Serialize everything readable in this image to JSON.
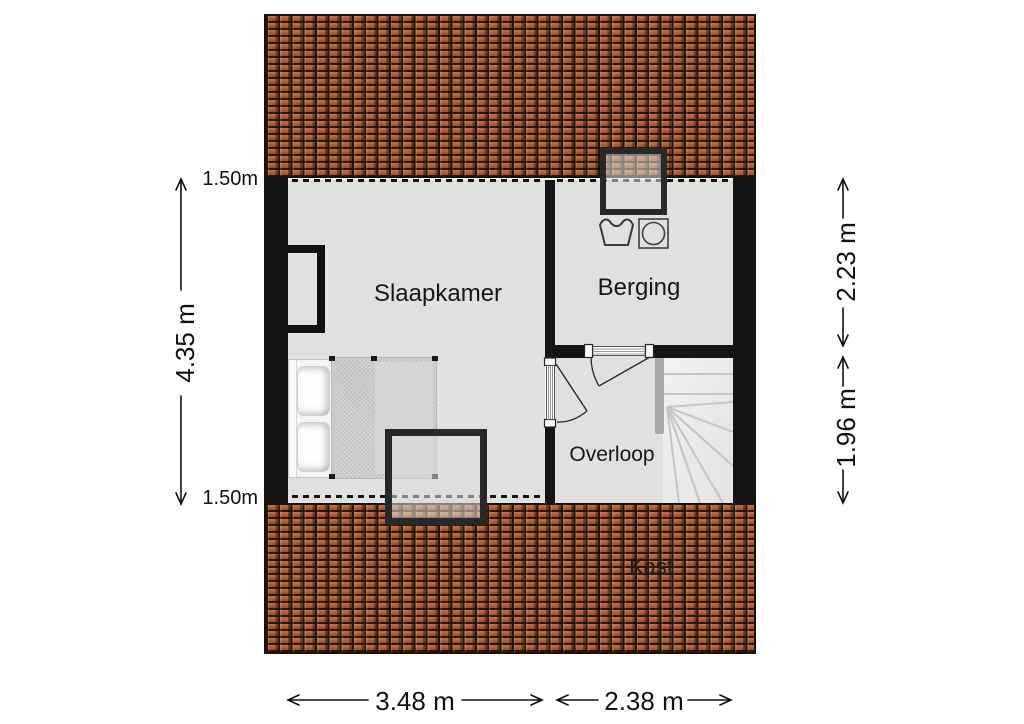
{
  "rooms": {
    "bedroom": {
      "label": "Slaapkamer"
    },
    "storage": {
      "label": "Berging"
    },
    "landing": {
      "label": "Overloop"
    },
    "closet": {
      "label": "Kast"
    }
  },
  "dimensions": {
    "left_total": "4.35 m",
    "left_knee_top": "1.50m",
    "left_knee_bottom": "1.50m",
    "right_upper": "2.23 m",
    "right_lower": "1.96 m",
    "bottom_left": "3.48 m",
    "bottom_right": "2.38 m"
  },
  "icons": {
    "roof_window_top": "roof-window",
    "roof_window_bottom": "roof-window",
    "wash_tub": "hand-wash-tub",
    "washing_machine": "washing-machine",
    "bed": "double-bed",
    "stairs": "winder-stairs"
  },
  "colors": {
    "roof": "#a35a33",
    "wall": "#141414",
    "floor": "#dfe1de",
    "stairs": "#ecedea",
    "handrail": "#a7a7a5",
    "text": "#161616"
  }
}
